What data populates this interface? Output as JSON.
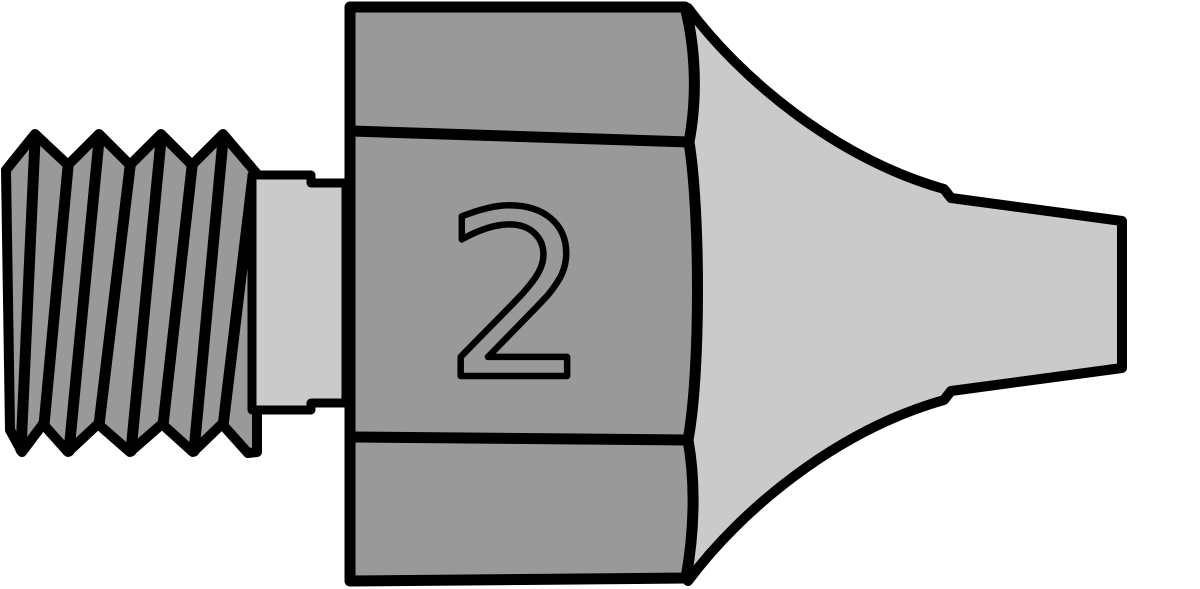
{
  "illustration": {
    "hex_body": {
      "marking": "2"
    }
  },
  "colors": {
    "background": "#ffffff",
    "body_gray": "#999999",
    "highlight_gray": "#cacaca",
    "outline": "#000000"
  }
}
